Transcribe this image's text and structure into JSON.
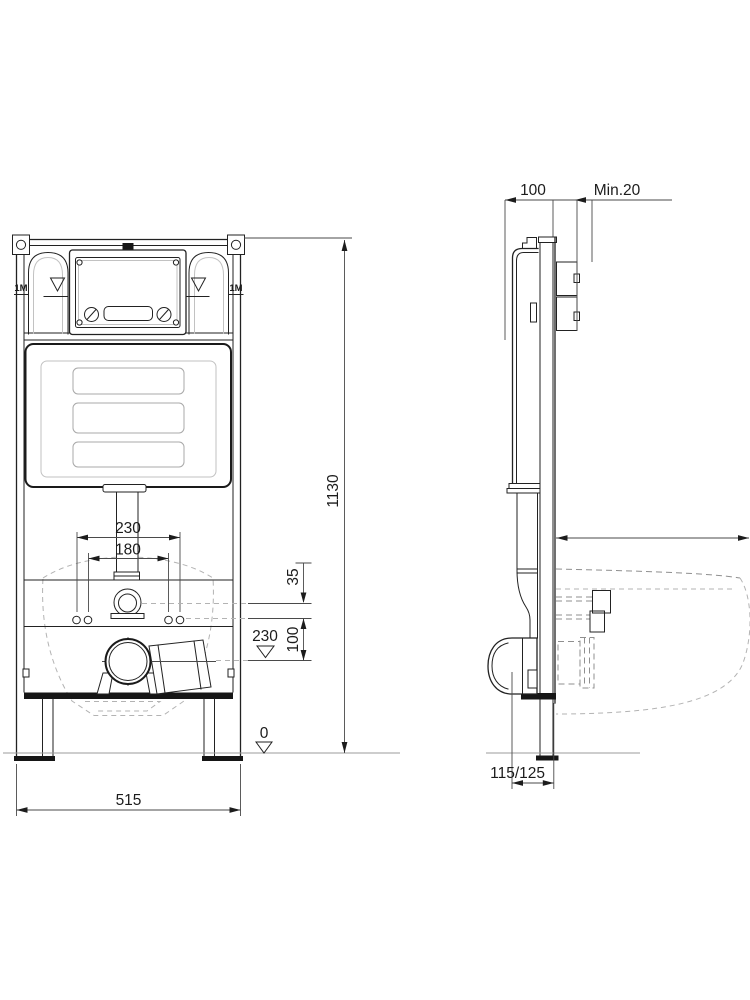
{
  "front_view": {
    "anchor_label_left": "1M",
    "anchor_label_right": "1M",
    "dim_rod_spacing_outer": "230",
    "dim_rod_spacing_inner": "180",
    "dim_inlet_offset": "35",
    "dim_drain_offset": "100",
    "dim_drain_height": "230",
    "dim_floor_datum": "0",
    "dim_frame_width": "515",
    "dim_frame_height": "1130"
  },
  "side_view": {
    "dim_frame_depth": "100",
    "dim_wall_min": "Min.20",
    "dim_outlet_distance": "115/125"
  }
}
